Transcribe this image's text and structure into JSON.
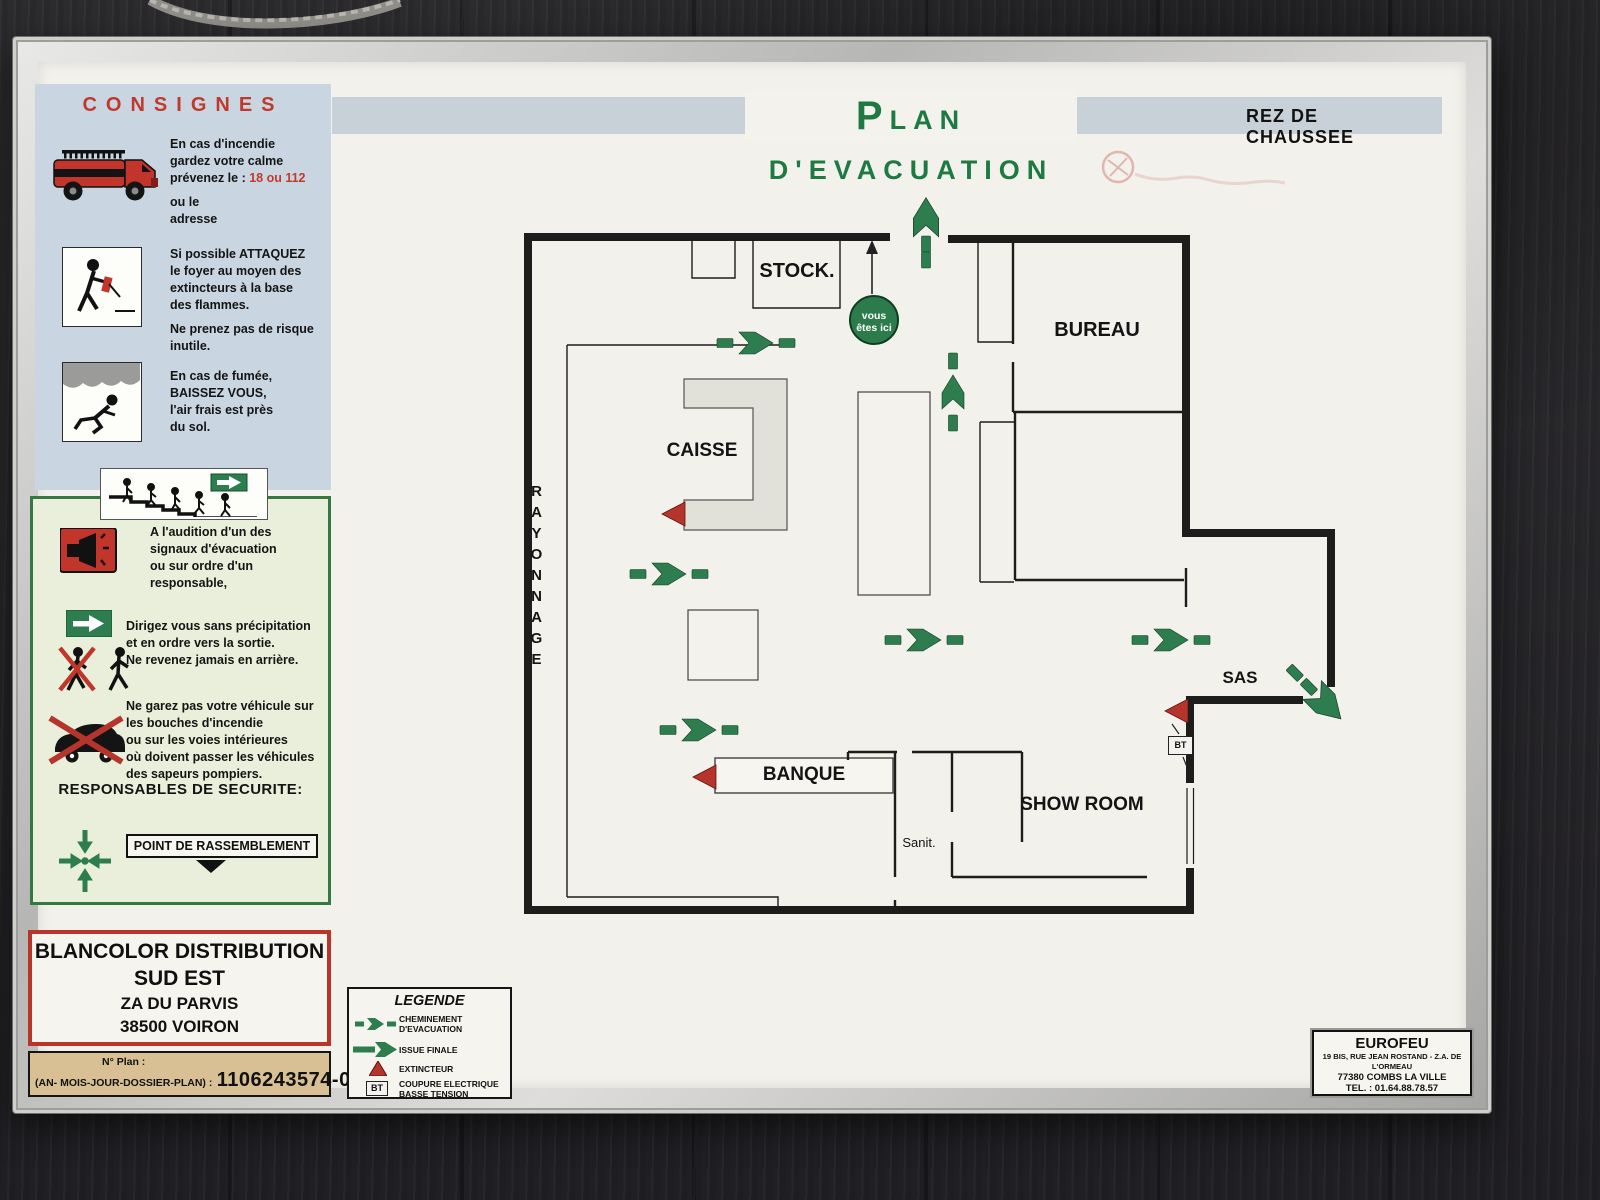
{
  "colors": {
    "title_green": "#1e7a42",
    "accent_red": "#bf3b2e",
    "wall_black": "#1d1d1b",
    "arrow_green": "#2e7d4e",
    "panel_blue": "#c9d6e1",
    "panel_green": "#e9efda",
    "plan_number_bg": "#d9c094"
  },
  "header": {
    "title": "PLAN D'EVACUATION",
    "floor": "REZ DE CHAUSSEE"
  },
  "consignes": {
    "title": "CONSIGNES",
    "fire_text": "En cas d'incendie\ngardez votre calme",
    "fire_call_prefix": "prévenez le : ",
    "fire_call_numbers": "18 ou 112",
    "fire_text2": "ou le\nadresse",
    "attack_text": "Si possible ATTAQUEZ\nle foyer au moyen des\nextincteurs à la base\ndes flammes.",
    "attack_text2": "Ne prenez pas de risque\ninutile.",
    "smoke_text": "En cas de fumée,\nBAISSEZ VOUS,\nl'air frais est près\ndu sol."
  },
  "evacuation": {
    "signal_text": "A l'audition d'un des\nsignaux d'évacuation\nou sur ordre d'un\nresponsable,",
    "exit_text": "Dirigez vous sans précipitation\net en ordre vers la sortie.\nNe revenez jamais en arrière.",
    "vehicle_text": "Ne garez pas votre véhicule sur\nles bouches d'incendie\nou sur les voies intérieures\noù doivent passer les véhicules\ndes sapeurs pompiers.",
    "responsables": "RESPONSABLES  DE SECURITE:",
    "rassemblement": "POINT DE RASSEMBLEMENT"
  },
  "company": {
    "line1": "BLANCOLOR DISTRIBUTION",
    "line2": "SUD EST",
    "line3": "ZA DU PARVIS",
    "line4": "38500 VOIRON"
  },
  "plan_number": {
    "label": "N° Plan :",
    "format": "(AN- MOIS-JOUR-DOSSIER-PLAN) :",
    "value": "1106243574-02"
  },
  "legend": {
    "title": "LEGENDE",
    "items": [
      {
        "icon": "dashed-route-arrow-icon",
        "label": "CHEMINEMENT\nD'EVACUATION"
      },
      {
        "icon": "solid-exit-arrow-icon",
        "label": "ISSUE FINALE"
      },
      {
        "icon": "extinguisher-triangle-icon",
        "label": "EXTINCTEUR"
      },
      {
        "icon": "bt-box-icon",
        "label": "COUPURE ELECTRIQUE\nBASSE TENSION"
      }
    ]
  },
  "plan": {
    "rooms": {
      "stock": "STOCK.",
      "bureau": "BUREAU",
      "caisse": "CAISSE",
      "rayonnage": "RAYONNAGE",
      "sas": "SAS",
      "banque": "BANQUE",
      "sanit": "Sanit.",
      "showroom": "SHOW ROOM"
    },
    "you_are_here": "vous\nêtes ici",
    "bt_label": "BT"
  },
  "supplier": {
    "name": "EUROFEU",
    "address": "19 BIS, RUE JEAN ROSTAND - Z.A. DE L'ORMEAU",
    "city": "77380 COMBS LA VILLE",
    "phone": "TEL. : 01.64.88.78.57"
  }
}
